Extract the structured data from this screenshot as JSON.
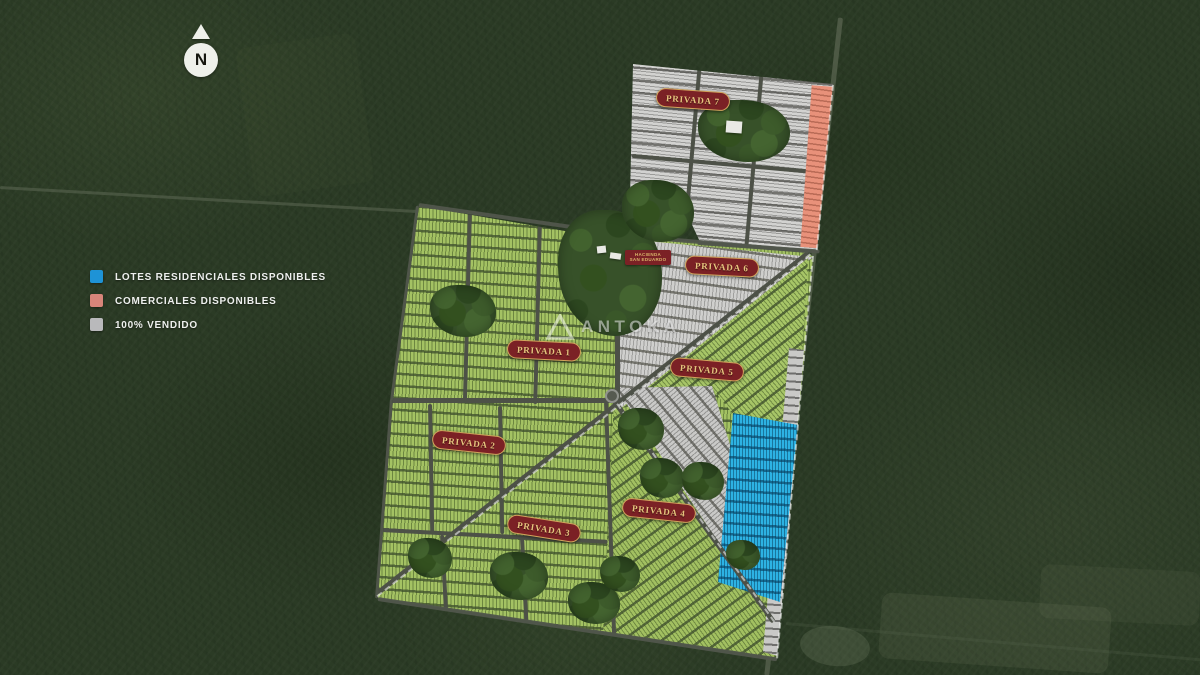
{
  "map": {
    "compass": {
      "icon": "north-arrow-icon",
      "letter": "N"
    },
    "watermark": {
      "icon": "antoka-logo-icon",
      "text": "ANTOKA"
    },
    "hacienda": {
      "line1": "HACIENDA",
      "line2": "SAN EDUARDO"
    },
    "privadas": [
      {
        "label": "PRIVADA 1",
        "lot_color": "green"
      },
      {
        "label": "PRIVADA 2",
        "lot_color": "green"
      },
      {
        "label": "PRIVADA 3",
        "lot_color": "green"
      },
      {
        "label": "PRIVADA 4",
        "lot_color": "green"
      },
      {
        "label": "PRIVADA 5",
        "lot_color": "green"
      },
      {
        "label": "PRIVADA 6",
        "lot_color": "gray"
      },
      {
        "label": "PRIVADA 7",
        "lot_color": "gray"
      }
    ],
    "zones": {
      "residential_available_color": "#2db2e3",
      "commercial_available_color": "#e8917a",
      "sold_color": "#cfcfcd",
      "label_color": "#7b2125",
      "label_text_color": "#e6c57e"
    }
  },
  "legend": {
    "items": [
      {
        "key": "residential-available",
        "label": "LOTES RESIDENCIALES DISPONIBLES",
        "color": "#1e93d6"
      },
      {
        "key": "commercial-available",
        "label": "COMERCIALES DISPONIBLES",
        "color": "#d8857a"
      },
      {
        "key": "sold",
        "label": "100% VENDIDO",
        "color": "#b9b9bb"
      }
    ]
  }
}
